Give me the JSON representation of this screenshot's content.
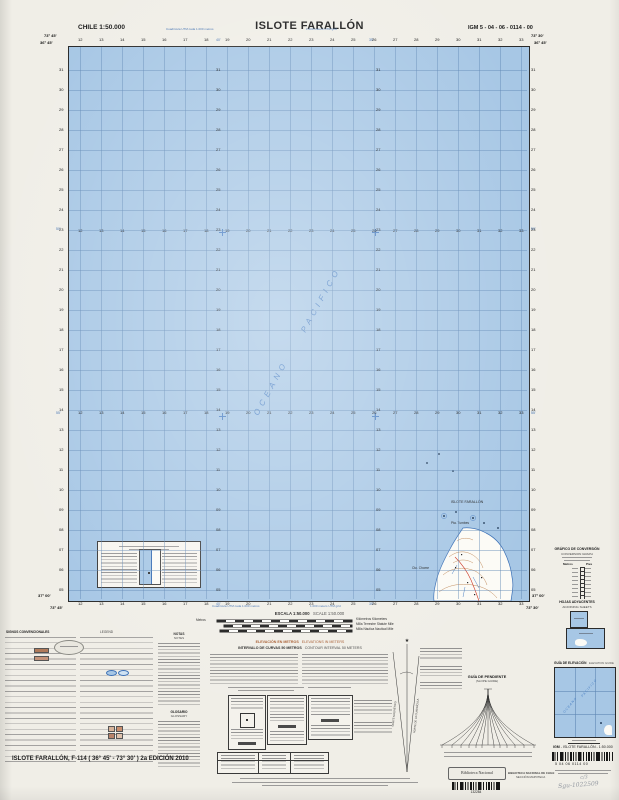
{
  "header": {
    "left": "CHILE  1:50.000",
    "title": "ISLOTE FARALLÓN",
    "right": "IGM 5 - 04 - 06 - 0114 - 00"
  },
  "map": {
    "blue_note_es": "Cuadrícula UTM cada 1.000 metros",
    "blue_note_en": "1.000 meters UTM grid",
    "corners": {
      "tl_lon": "73° 45'",
      "tr_lon": "73° 30'",
      "lat_n": "36° 45'",
      "lat_s": "37° 00'"
    },
    "minutes": {
      "lon1": "40'",
      "lon2": "35'",
      "lat1": "50'",
      "lat2": "55'"
    },
    "grid": {
      "col_start": 12,
      "col_end": 33,
      "row_start": 5,
      "row_end": 31
    },
    "ocean1": "OCEANO",
    "ocean2": "PACIFICO",
    "islet_label": "ISLOTE FARALLÓN",
    "land1": "Pta. Tumbes",
    "land2": "Cta. Chome"
  },
  "scale": {
    "es": "ESCALA  1:50.000",
    "en": "SCALE  1:50.000",
    "metros": "Metros",
    "r1": "Kilómetros   Kilometers",
    "r2": "Milla Terrestre   Statute Mile",
    "r3": "Milla Náutica   Nautical Mile"
  },
  "elevation": {
    "es": "ELEVACIÓN EN METROS",
    "en": "ELEVATIONS IN METERS",
    "int_es": "INTERVALO DE CURVAS 50 METROS",
    "int_en": "CONTOUR INTERVAL 50 METERS"
  },
  "legend": {
    "es": "SIGNOS CONVENCIONALES",
    "en": "LEGEND"
  },
  "notes": {
    "es": "NOTAS",
    "en": "NOTES"
  },
  "glossary": {
    "es": "GLOSARIO",
    "en": "GLOSSARY"
  },
  "slope": {
    "es": "GUÍA DE PENDIENTE",
    "en": "(SLOPE GUIDE)"
  },
  "declination": {
    "m": "NORTE MAGNÉTICO",
    "g": "NORTE DE LA CUADRÍCULA",
    "star": "★"
  },
  "conv": {
    "es": "GRÁFICO DE CONVERSIÓN",
    "en": "CONVERSION GRAPH",
    "l": "Metros",
    "r": "Pies"
  },
  "adj": {
    "es": "HOJAS ADYACENTES",
    "en": "ADJOINING SHEETS"
  },
  "eg": {
    "es": "GUÍA DE ELEVACIÓN",
    "en": "ELEVATION GUIDE"
  },
  "edition": "ISLOTE FARALLÓN,  F-114  ( 36° 45' - 73° 30' )  2a EDICIÓN 2010",
  "igm_footer": {
    "brand": "IGM",
    "name": "-  ISLOTE FARALLÓN  -  1:50.000",
    "code": "5     04     06     0114     00"
  },
  "library": {
    "stamp": "Biblioteca Nacional",
    "num": "132284",
    "l1": "BIBLIOTECA NACIONAL DE CHILE",
    "l2": "SECCIÓN MAPOTECA"
  },
  "hand": {
    "l1": "c/3",
    "l2": "Sgu-1022509"
  },
  "colors": {
    "paper": "#f0eee7",
    "ocean": "#a7c7e5",
    "grid_line": "#5f87b4",
    "accent_blue": "#3f6fb0",
    "heading_brown": "#a3562a",
    "contour_brown": "#c08a5a",
    "road_red": "#cc3322"
  }
}
